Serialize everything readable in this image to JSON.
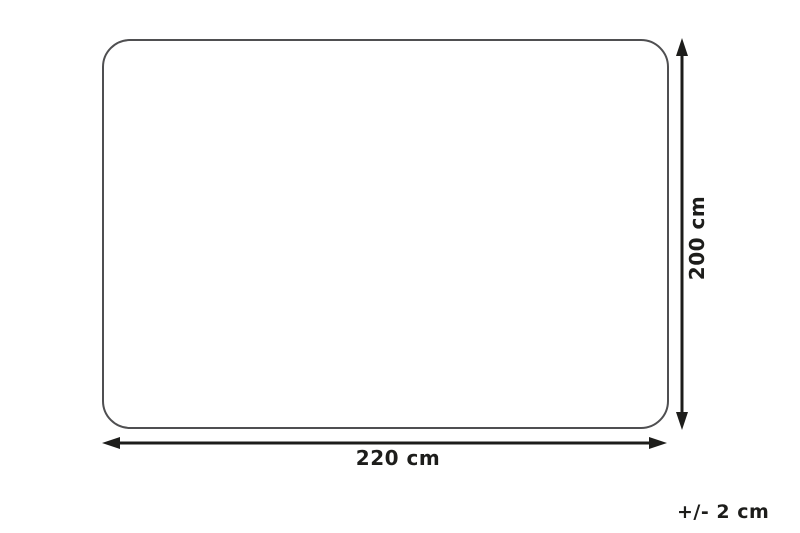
{
  "diagram": {
    "type": "product-dimension-diagram",
    "width_label": "220 cm",
    "height_label": "200 cm",
    "tolerance_label": "+/- 2 cm",
    "width_value_cm": 220,
    "height_value_cm": 200,
    "tolerance_cm": 2,
    "outline_color": "#4f4f51",
    "arrow_color": "#1d1d1b",
    "background_color": "#ffffff"
  }
}
